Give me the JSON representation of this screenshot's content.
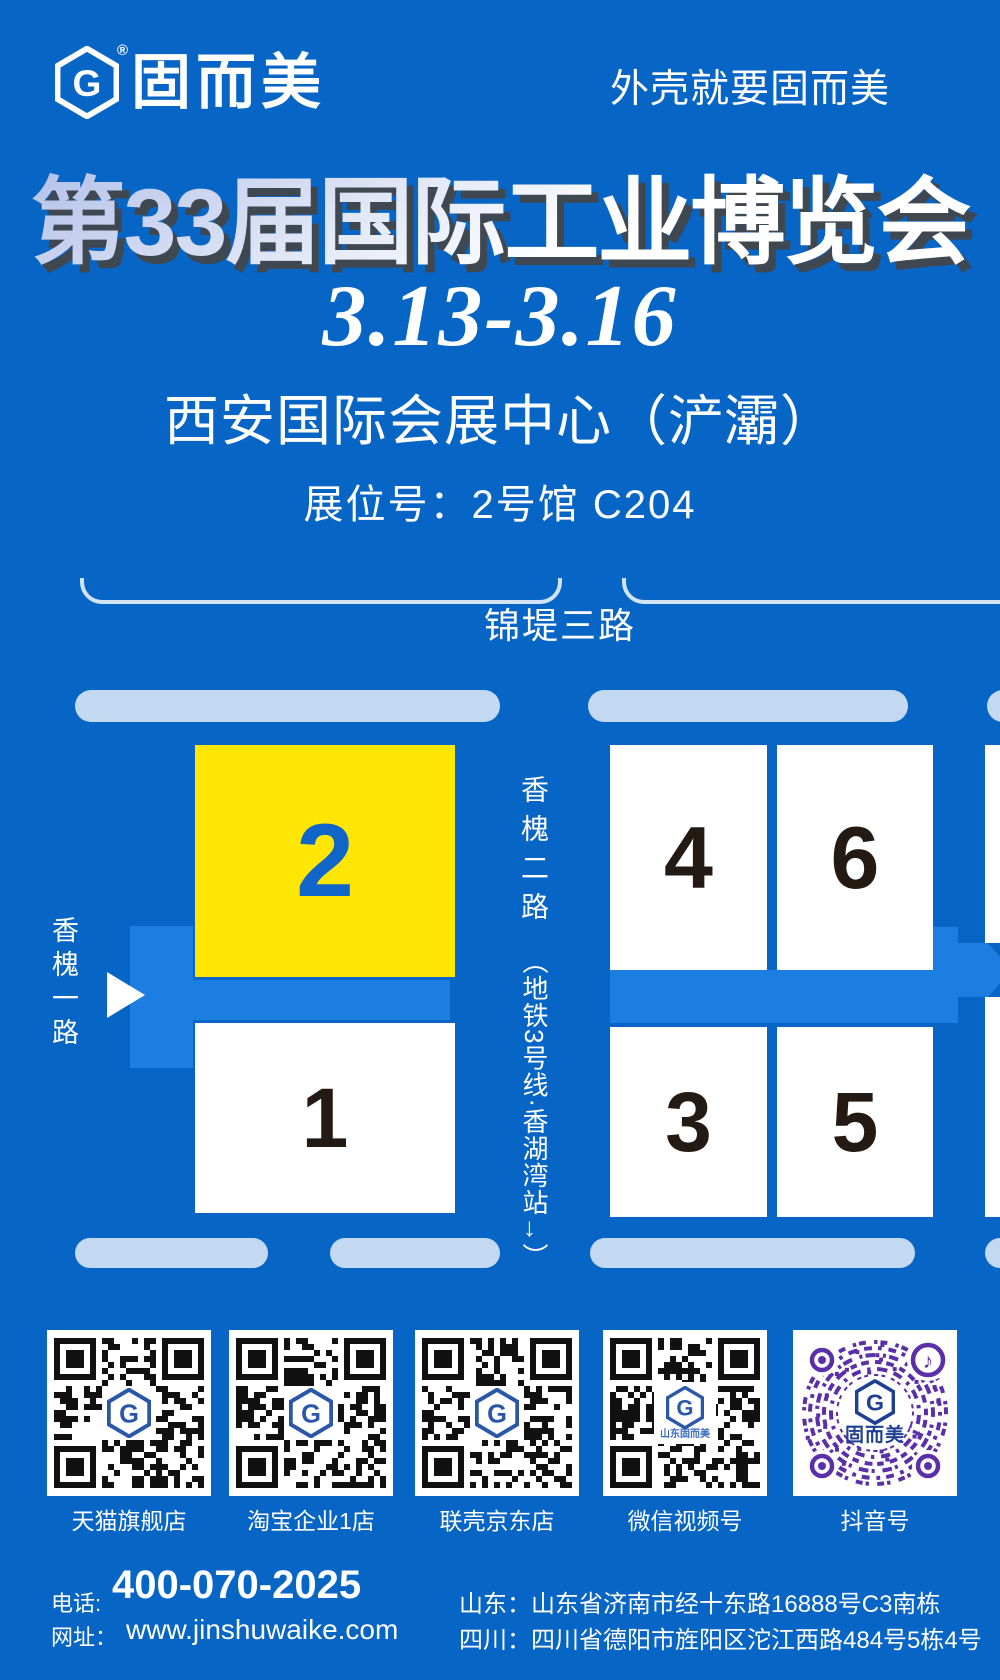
{
  "brand": {
    "name": "固而美",
    "registered": "®",
    "slogan": "外壳就要固而美",
    "logo_letter": "G"
  },
  "hero": {
    "title": "第33届国际工业博览会",
    "dates": "3.13-3.16",
    "venue": "西安国际会展中心（浐灞）",
    "booth": "展位号：2号馆 C204"
  },
  "map": {
    "top_road": "锦堤三路",
    "left_road": "香槐一路",
    "mid_road": "香槐二路",
    "metro_note": "（地铁3号线·香湖湾站→）",
    "halls": [
      {
        "label": "2",
        "highlight": true
      },
      {
        "label": "1",
        "highlight": false
      },
      {
        "label": "4",
        "highlight": false
      },
      {
        "label": "6",
        "highlight": false
      },
      {
        "label": "3",
        "highlight": false
      },
      {
        "label": "5",
        "highlight": false
      }
    ]
  },
  "qr": {
    "items": [
      {
        "label": "天猫旗舰店",
        "style": "qr-logo"
      },
      {
        "label": "淘宝企业1店",
        "style": "qr-logo"
      },
      {
        "label": "联壳京东店",
        "style": "qr-logo"
      },
      {
        "label": "微信视频号",
        "style": "qr-logo-text",
        "subtext": "山东固而美"
      },
      {
        "label": "抖音号",
        "style": "douyin",
        "center_text": "固而美"
      }
    ]
  },
  "contact": {
    "phone_label": "电话:",
    "phone": "400-070-2025",
    "web_label": "网址：",
    "website": "www.jinshuwaike.com",
    "addresses": [
      {
        "region": "山东：",
        "text": "山东省济南市经十东路16888号C3南栋"
      },
      {
        "region": "四川：",
        "text": "四川省德阳市旌阳区沱江西路484号5栋4号"
      }
    ]
  },
  "colors": {
    "background": "#0765c6",
    "road": "#1d7ee2",
    "road_pale": "#c3d9f1",
    "hall_highlight": "#ffe604",
    "hall_number": "#241a14",
    "highlight_number": "#0f65c8",
    "title_shadow": "#3f4750",
    "douyin_purple": "#5b2fa8",
    "logo_navy": "#23489c"
  }
}
